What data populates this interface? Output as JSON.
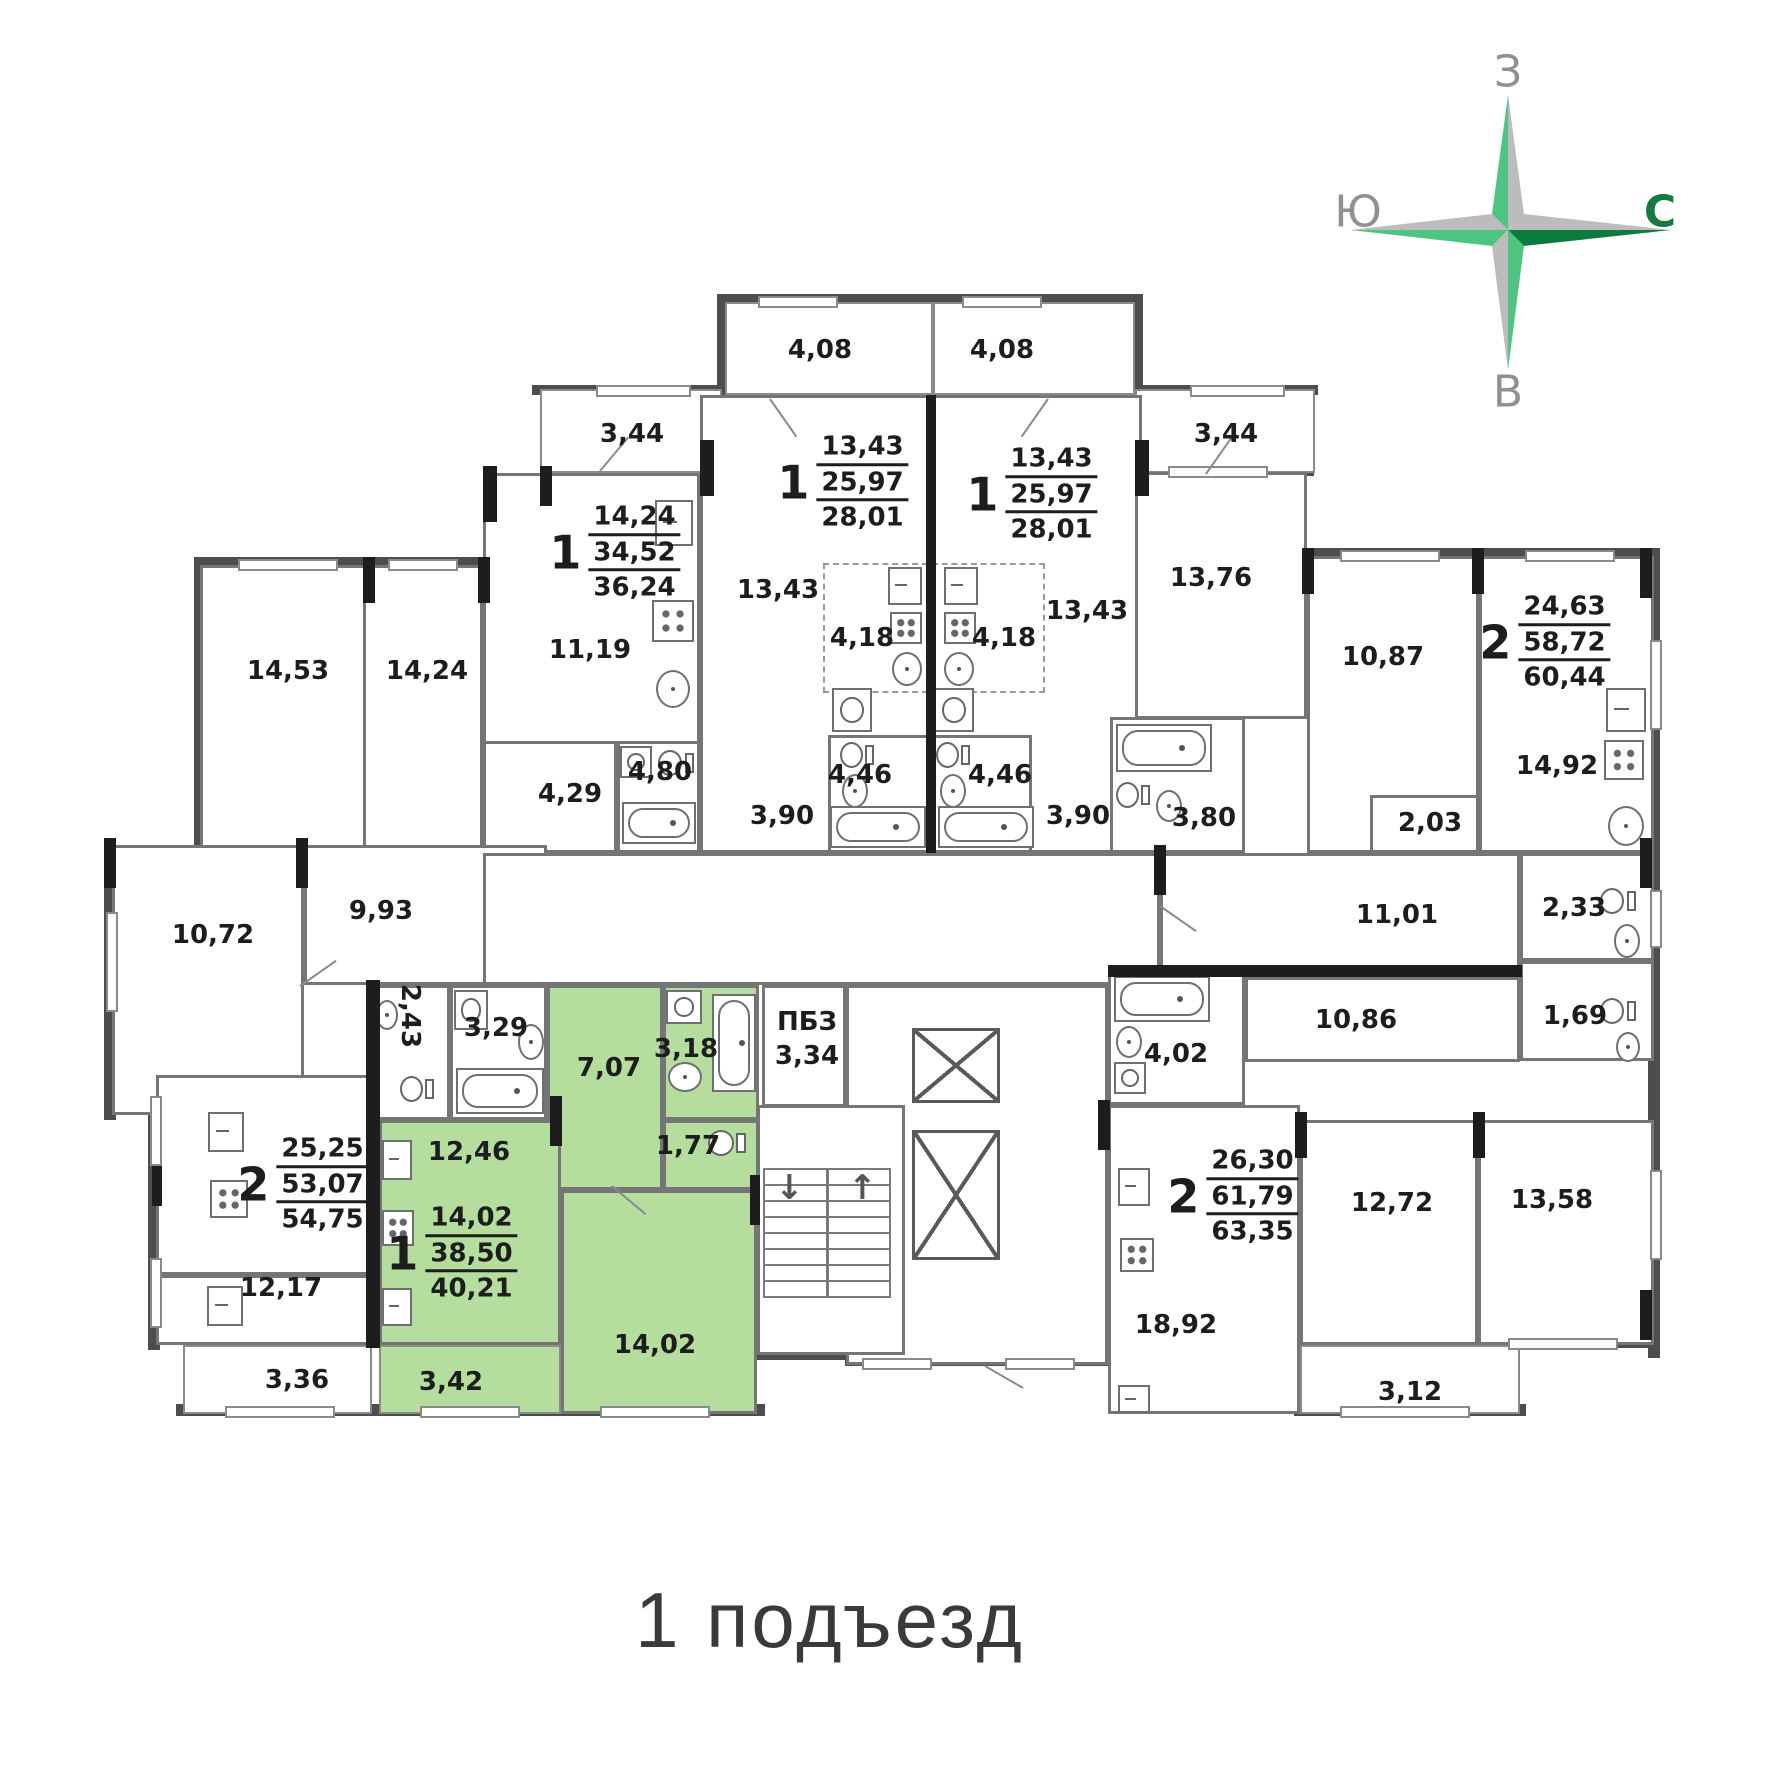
{
  "title": "1 подъезд",
  "compass": {
    "top": "З",
    "left": "Ю",
    "right": "С",
    "bottom": "В"
  },
  "colors": {
    "highlight": "#b5dd9e",
    "compass_light_green": "#4fc482",
    "compass_dark_green": "#0f7a3e",
    "compass_gray": "#bcbcbc",
    "wall_dark": "#1d1d1d",
    "wall_gray": "#4d4d4d",
    "partition_gray": "#757575",
    "text": "#1d1d1d"
  },
  "special_zone": {
    "name": "ПБЗ",
    "area": "3,34"
  },
  "apartments": [
    {
      "num": "1",
      "v1": "14,24",
      "v2": "34,52",
      "v3": "36,24"
    },
    {
      "num": "1",
      "v1": "13,43",
      "v2": "25,97",
      "v3": "28,01"
    },
    {
      "num": "1",
      "v1": "13,43",
      "v2": "25,97",
      "v3": "28,01"
    },
    {
      "num": "2",
      "v1": "24,63",
      "v2": "58,72",
      "v3": "60,44"
    },
    {
      "num": "2",
      "v1": "25,25",
      "v2": "53,07",
      "v3": "54,75"
    },
    {
      "num": "1",
      "v1": "14,02",
      "v2": "38,50",
      "v3": "40,21",
      "highlighted": true
    },
    {
      "num": "2",
      "v1": "26,30",
      "v2": "61,79",
      "v3": "63,35"
    }
  ],
  "labels": [
    {
      "id": "balcony-top-left",
      "text": "4,08"
    },
    {
      "id": "balcony-top-right",
      "text": "4,08"
    },
    {
      "id": "balcony-upper-left",
      "text": "3,44"
    },
    {
      "id": "balcony-upper-right",
      "text": "3,44"
    },
    {
      "id": "room-14-53",
      "text": "14,53"
    },
    {
      "id": "room-14-24",
      "text": "14,24"
    },
    {
      "id": "room-11-19",
      "text": "11,19"
    },
    {
      "id": "room-13-43-left",
      "text": "13,43"
    },
    {
      "id": "room-13-43-right",
      "text": "13,43"
    },
    {
      "id": "kitchen-4-18-left",
      "text": "4,18"
    },
    {
      "id": "kitchen-4-18-right",
      "text": "4,18"
    },
    {
      "id": "bath-4-80",
      "text": "4,80"
    },
    {
      "id": "hall-4-29",
      "text": "4,29"
    },
    {
      "id": "hall-3-90-left",
      "text": "3,90"
    },
    {
      "id": "bath-4-46-left",
      "text": "4,46"
    },
    {
      "id": "bath-4-46-right",
      "text": "4,46"
    },
    {
      "id": "hall-3-90-right",
      "text": "3,90"
    },
    {
      "id": "room-13-76",
      "text": "13,76"
    },
    {
      "id": "room-10-87",
      "text": "10,87"
    },
    {
      "id": "bath-3-80",
      "text": "3,80"
    },
    {
      "id": "kitchen-14-92",
      "text": "14,92"
    },
    {
      "id": "hall-2-03",
      "text": "2,03"
    },
    {
      "id": "room-10-72",
      "text": "10,72"
    },
    {
      "id": "hall-9-93",
      "text": "9,93"
    },
    {
      "id": "wc-2-43",
      "text": "2,43"
    },
    {
      "id": "bath-3-29",
      "text": "3,29"
    },
    {
      "id": "hall-7-07",
      "text": "7,07"
    },
    {
      "id": "bath-3-18",
      "text": "3,18"
    },
    {
      "id": "pbz-name",
      "text": "ПБЗ"
    },
    {
      "id": "pbz-area",
      "text": "3,34"
    },
    {
      "id": "wc-1-77",
      "text": "1,77"
    },
    {
      "id": "hall-11-01",
      "text": "11,01"
    },
    {
      "id": "bath-2-33",
      "text": "2,33"
    },
    {
      "id": "wc-1-69",
      "text": "1,69"
    },
    {
      "id": "hall-10-86",
      "text": "10,86"
    },
    {
      "id": "bath-4-02",
      "text": "4,02"
    },
    {
      "id": "kitchen-12-46",
      "text": "12,46"
    },
    {
      "id": "room-12-17",
      "text": "12,17"
    },
    {
      "id": "room-14-02",
      "text": "14,02"
    },
    {
      "id": "balcony-3-36",
      "text": "3,36"
    },
    {
      "id": "balcony-3-42",
      "text": "3,42"
    },
    {
      "id": "room-18-92",
      "text": "18,92"
    },
    {
      "id": "room-12-72",
      "text": "12,72"
    },
    {
      "id": "room-13-58",
      "text": "13,58"
    },
    {
      "id": "balcony-3-12",
      "text": "3,12"
    }
  ]
}
